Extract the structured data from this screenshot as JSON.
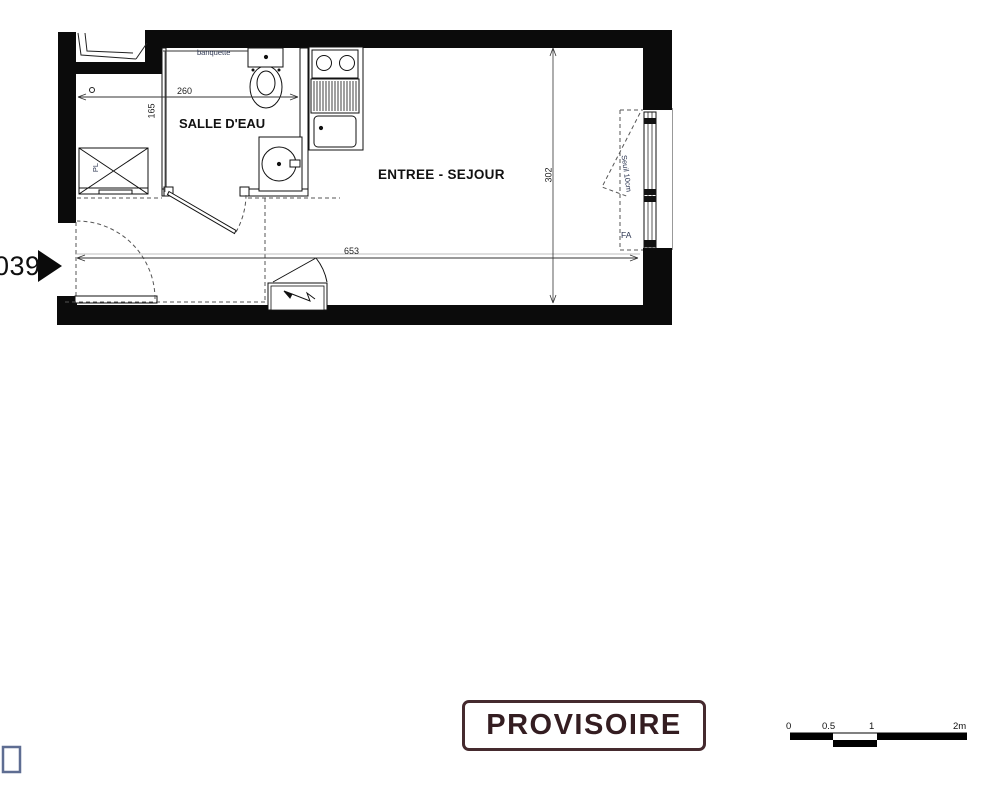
{
  "plan": {
    "unit_label": "039",
    "room_bathroom": "SALLE D'EAU",
    "room_main": "ENTREE - SEJOUR",
    "label_banquette": "banquette",
    "label_closet": "PL",
    "label_sill": "Seuil 10cm",
    "label_window": "FA",
    "dim_bathroom_width": "260",
    "dim_bathroom_depth": "165",
    "dim_room_width": "653",
    "dim_room_depth": "302"
  },
  "stamp": {
    "text": "PROVISOIRE",
    "color": "#341d21",
    "border_color": "#452a2e"
  },
  "scale_bar": {
    "ticks": [
      "0",
      "0.5",
      "1",
      "2m"
    ],
    "color": "#000000"
  }
}
